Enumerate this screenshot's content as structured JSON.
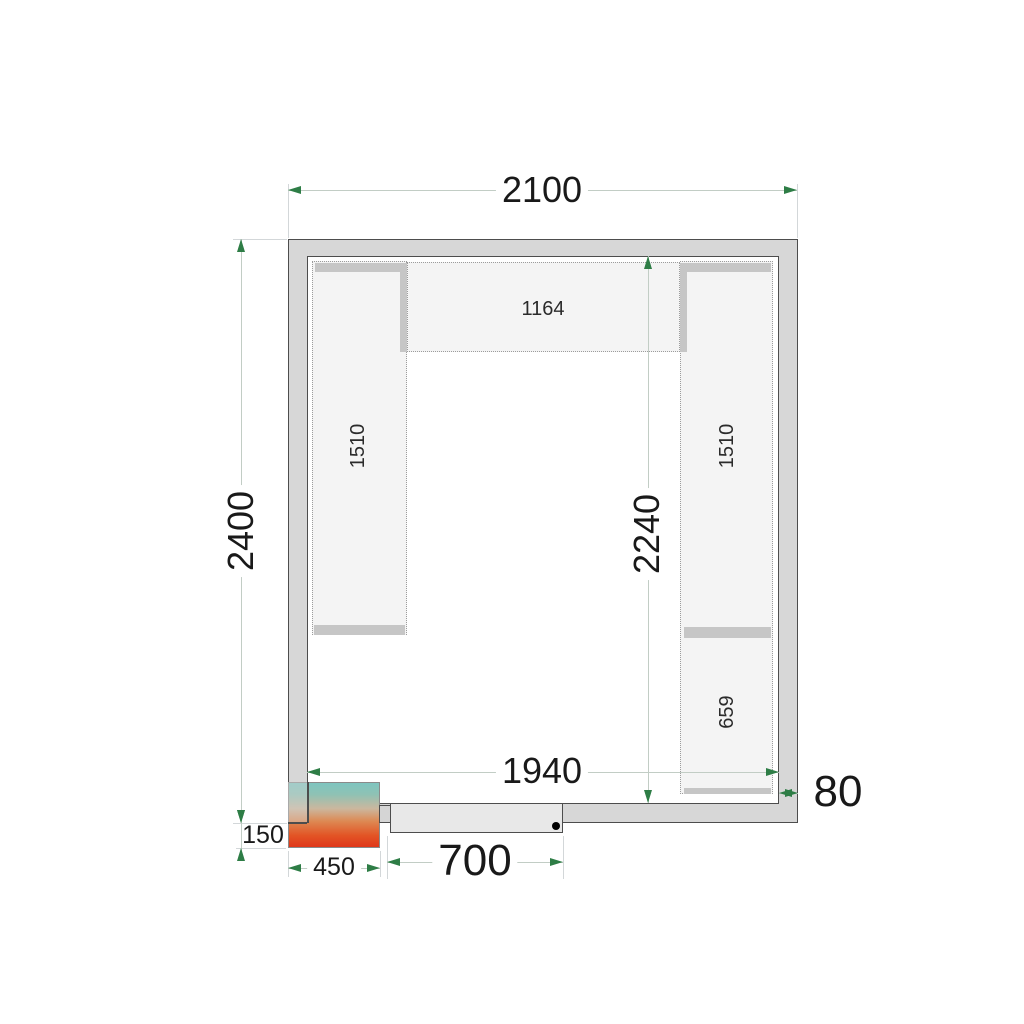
{
  "plan": {
    "title": "cold-room floor plan",
    "dims": {
      "total_width": "2100",
      "total_depth": "2400",
      "inner_depth": "2240",
      "inner_width": "1940",
      "wall_thickness": "80",
      "door_width": "700",
      "unit_width": "450",
      "unit_protrusion": "150"
    },
    "shelves": {
      "top_length": "1164",
      "left_length": "1510",
      "right_length": "1510",
      "right_lower_length": "659"
    },
    "colors": {
      "wall_fill": "#d7d7d7",
      "outline": "#4d4d4d",
      "shelf_fill": "#f4f4f4",
      "rail": "#c6c6c6",
      "dimension_line": "#c2cdc5",
      "extension_line": "#d3d7d9",
      "arrow_green": "#2e7d46",
      "unit_gradient_top": "#7ec5c0",
      "unit_gradient_bottom": "#e0371a",
      "door_leaf": "#e8e8e8",
      "hinge_dot": "#000000"
    }
  }
}
